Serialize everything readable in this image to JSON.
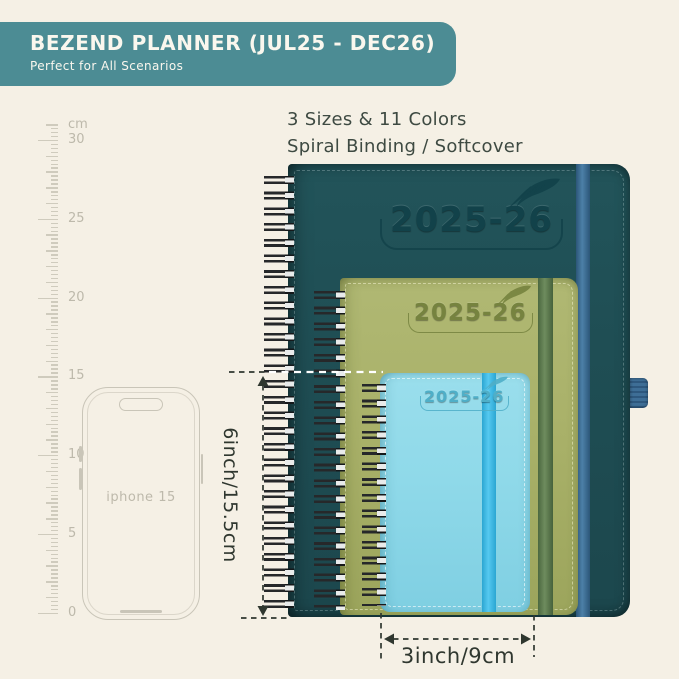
{
  "banner": {
    "title": "BEZEND PLANNER (JUL25 - DEC26)",
    "subtitle": "Perfect for All Scenarios"
  },
  "info": {
    "line1": "3 Sizes & 11 Colors",
    "line2": "Spiral Binding / Softcover"
  },
  "ruler": {
    "unit_label": "cm",
    "major_labels": [
      "30",
      "25",
      "20",
      "15",
      "10",
      "5",
      "0"
    ]
  },
  "phone": {
    "label": "iphone 15"
  },
  "notebooks": [
    {
      "name": "large",
      "year_label": "2025-26"
    },
    {
      "name": "medium",
      "year_label": "2025-26"
    },
    {
      "name": "small",
      "year_label": "2025-26"
    }
  ],
  "dimensions": {
    "height_label": "6inch/15.5cm",
    "width_label": "3inch/9cm"
  },
  "colors": {
    "background": "#F5F0E5",
    "banner": "#4C8C94",
    "banner_text": "#FAF7EE",
    "ink": "#3E4A42",
    "ruler": "#CFCBBD",
    "ruler_text": "#BDB9AB",
    "phone_outline": "#C9C5B8",
    "notebook_large": "#1F4E54",
    "notebook_large_band": "#4C80A8",
    "notebook_medium": "#A9B169",
    "notebook_medium_band": "#6E8C5E",
    "notebook_small": "#8FD9E9",
    "notebook_small_band": "#55C9F0",
    "dimension": "#2F372F"
  }
}
